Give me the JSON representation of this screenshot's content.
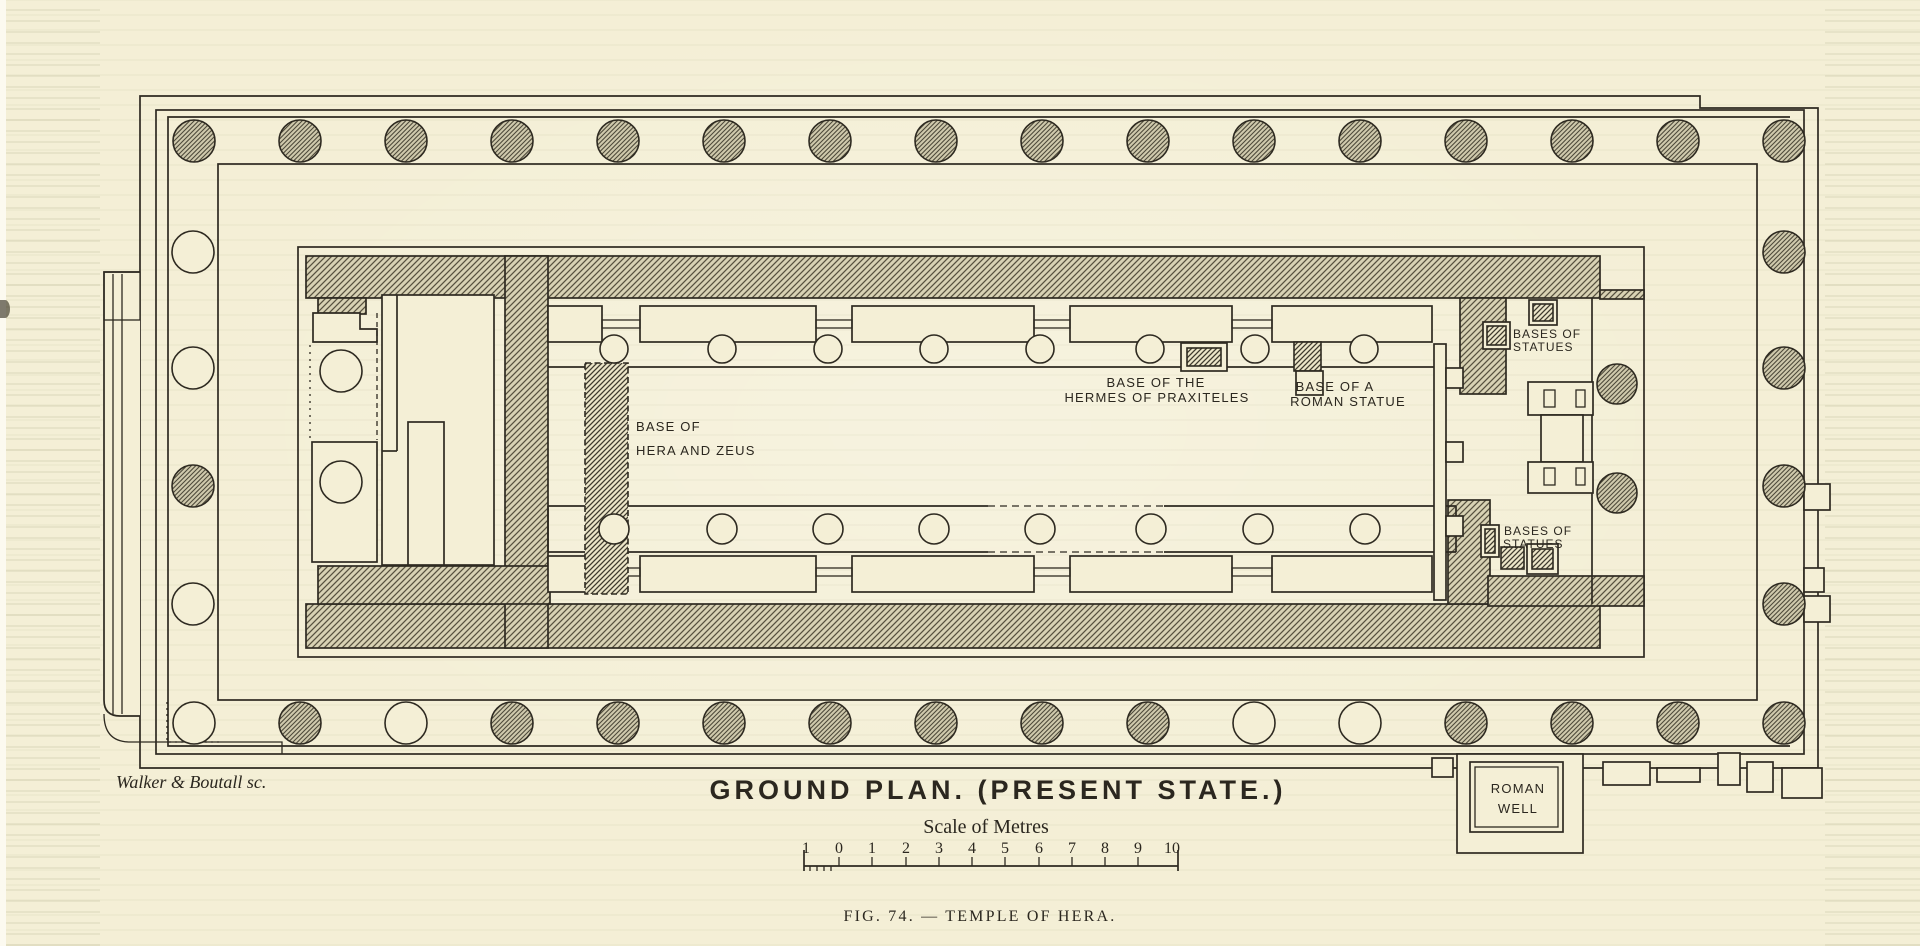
{
  "figure": {
    "title": "GROUND PLAN. (PRESENT STATE.)",
    "scale_label": "Scale of Metres",
    "scale_numbers": [
      "1",
      "0",
      "1",
      "2",
      "3",
      "4",
      "5",
      "6",
      "7",
      "8",
      "9",
      "10"
    ],
    "caption": "FIG. 74. — TEMPLE OF HERA.",
    "credit": "Walker & Boutall sc."
  },
  "labels": {
    "base_hera_line1": "BASE OF",
    "base_hera_line2": "HERA AND ZEUS",
    "base_hermes_line1": "BASE OF THE",
    "base_hermes_line2": "HERMES OF PRAXITELES",
    "base_roman_line1": "BASE OF A",
    "base_roman_line2": "ROMAN STATUE",
    "bases_statues_ne_line1": "BASES OF",
    "bases_statues_ne_line2": "STATUES",
    "bases_statues_se_line1": "BASES OF",
    "bases_statues_se_line2": "STATUES",
    "roman_well_line1": "ROMAN",
    "roman_well_line2": "WELL"
  },
  "colors": {
    "paper": "#f4efd6",
    "ink": "#2e2a21",
    "column_hatch_fill": "#cfc9ac",
    "wall_hatch_fill": "#d8d2b4"
  },
  "plan": {
    "legend_note_hatched": "standing (hatched) column",
    "legend_note_open": "missing (open) column base",
    "peristyle": {
      "radius": 21,
      "rows": [
        {
          "name": "north-colonnade",
          "y": 141,
          "x_start": 194,
          "x_step": 106,
          "states": [
            "h",
            "h",
            "h",
            "h",
            "h",
            "h",
            "h",
            "h",
            "h",
            "h",
            "h",
            "h",
            "h",
            "h",
            "h",
            "h"
          ]
        },
        {
          "name": "south-colonnade",
          "y": 723,
          "x_start": 194,
          "x_step": 106,
          "states": [
            "o",
            "h",
            "o",
            "h",
            "h",
            "h",
            "h",
            "h",
            "h",
            "h",
            "o",
            "o",
            "h",
            "h",
            "h",
            "h"
          ]
        }
      ],
      "west_colonnade": {
        "x": 193,
        "ys": [
          252,
          368,
          486,
          604
        ],
        "states": [
          "o",
          "o",
          "h",
          "o"
        ]
      },
      "east_colonnade": {
        "x": 1784,
        "ys": [
          252,
          368,
          486,
          604
        ],
        "states": [
          "h",
          "h",
          "h",
          "h"
        ]
      }
    },
    "interior_columns": {
      "north_row": {
        "y": 349,
        "r": 14,
        "xs": [
          614,
          722,
          828,
          934,
          1040,
          1150,
          1255,
          1364
        ],
        "state": "o"
      },
      "south_row": {
        "y": 529,
        "r": 15,
        "xs": [
          614,
          722,
          828,
          934,
          1040,
          1151,
          1258,
          1365
        ],
        "state": "o"
      },
      "west_in_antis": {
        "x": 341,
        "r": 21,
        "ys": [
          371,
          482
        ],
        "state": "o"
      },
      "east_pronaos": {
        "x": 1617,
        "r": 20,
        "ys": [
          384,
          493
        ],
        "state": "h"
      }
    }
  }
}
